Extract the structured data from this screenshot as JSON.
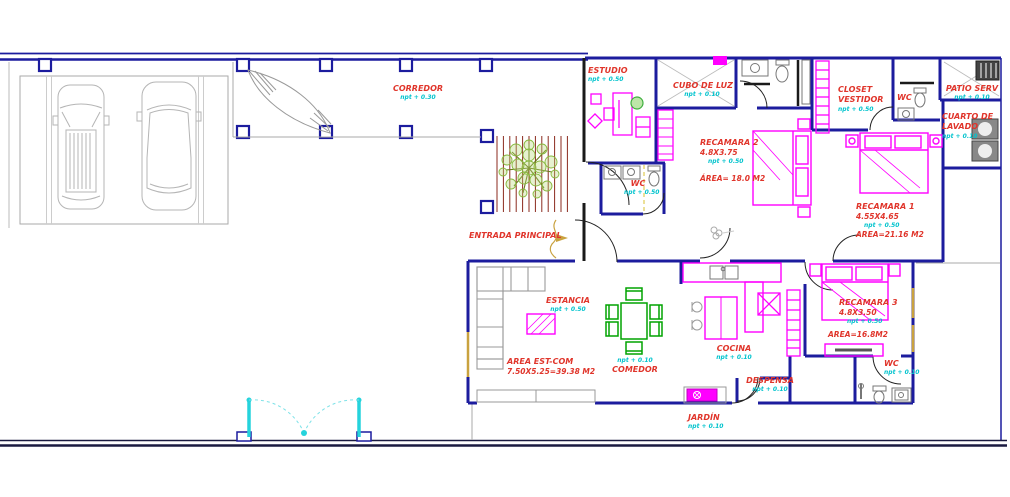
{
  "drawing_title": "Planta arquitectonica - casa habitacion",
  "colors": {
    "wall_navy": "#1c1c9e",
    "wall_black": "#1a1a1a",
    "furniture_magenta": "#ff00ff",
    "label_red": "#e0352b",
    "label_cyan": "#00c3cd",
    "dining_green": "#00a300",
    "tree_green": "#86b83c",
    "pergola_red": "#8b2a1e",
    "gate_cyan": "#25d3dc",
    "accent_tan": "#c9a23f",
    "drawing_gray": "#9a9a9a"
  },
  "rooms": [
    {
      "id": "corredor",
      "name": "CORREDOR",
      "npt": "npt + 0.30"
    },
    {
      "id": "estudio",
      "name": "ESTUDIO",
      "npt": "npt + 0.50"
    },
    {
      "id": "cubo-de-luz",
      "name": "CUBO DE LUZ",
      "npt": "npt + 0.10"
    },
    {
      "id": "wc-estudio",
      "name": "WC",
      "npt": "npt + 0.50"
    },
    {
      "id": "recamara-2",
      "name": "RECAMARA 2",
      "dims": "4.8X3.75",
      "npt": "npt + 0.50",
      "area": "ÁREA= 18.0 M2"
    },
    {
      "id": "closet-vestidor",
      "name": "CLOSET VESTIDOR",
      "npt": "npt + 0.50"
    },
    {
      "id": "wc-recamaras",
      "name": "WC"
    },
    {
      "id": "patio-serv",
      "name": "PATIO SERV",
      "npt": "npt + 0.10"
    },
    {
      "id": "cuarto-de-lavado",
      "name": "CUARTO DE LAVADO",
      "npt": "npt + 0.10"
    },
    {
      "id": "recamara-1",
      "name": "RECAMARA 1",
      "dims": "4.55X4.65",
      "npt": "npt + 0.50",
      "area": "AREA=21.16 M2"
    },
    {
      "id": "entrada-principal",
      "name": "ENTRADA PRINCIPAL"
    },
    {
      "id": "estancia",
      "name": "ESTANCIA",
      "npt": "npt + 0.50"
    },
    {
      "id": "area-est-com",
      "name": "AREA EST-COM",
      "dims": "7.50X5.25=39.38 M2"
    },
    {
      "id": "comedor",
      "name": "COMEDOR",
      "npt": "npt + 0.10"
    },
    {
      "id": "cocina",
      "name": "COCINA",
      "npt": "npt + 0.10"
    },
    {
      "id": "recamara-3",
      "name": "RECAMARA 3",
      "dims": "4.8X3.50",
      "npt": "npt + 0.50",
      "area": "AREA=16.8M2"
    },
    {
      "id": "despensa",
      "name": "DESPENSA",
      "npt": "npt + 0.10"
    },
    {
      "id": "wc-planta-baja",
      "name": "WC",
      "npt": "npt + 0.10"
    },
    {
      "id": "jardin",
      "name": "JARDÍN",
      "npt": "npt + 0.10"
    }
  ]
}
